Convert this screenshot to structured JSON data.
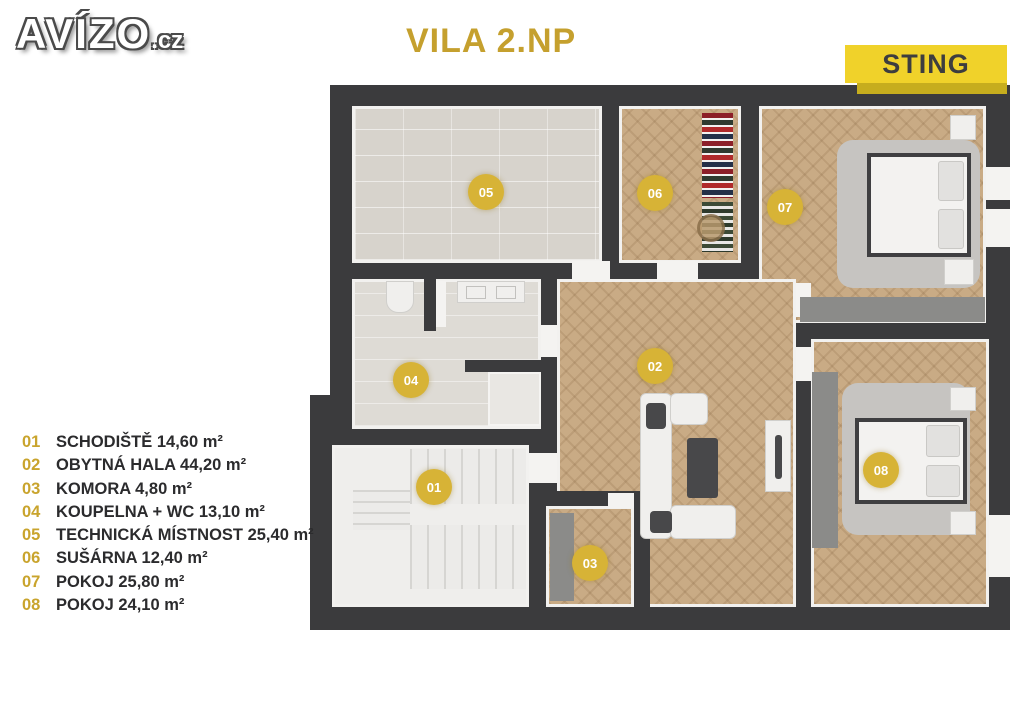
{
  "logo": {
    "main": "AVÍZO",
    "suffix": ".cz"
  },
  "title": "VILA 2.NP",
  "brand_badge": "STING",
  "colors": {
    "accent_gold": "#c5a02e",
    "badge_gold": "#d7b336",
    "sting_yellow": "#f0d22a",
    "wall_dark": "#3b3b3d",
    "wood_floor": "#c9ab85",
    "tile_floor": "#d7d3cc"
  },
  "floorplan": {
    "rooms": [
      {
        "number": "01"
      },
      {
        "number": "02"
      },
      {
        "number": "03"
      },
      {
        "number": "04"
      },
      {
        "number": "05"
      },
      {
        "number": "06"
      },
      {
        "number": "07"
      },
      {
        "number": "08"
      }
    ]
  },
  "legend": {
    "items": [
      {
        "number": "01",
        "label": "SCHODIŠTĚ 14,60 m²"
      },
      {
        "number": "02",
        "label": "OBYTNÁ HALA 44,20 m²"
      },
      {
        "number": "03",
        "label": "KOMORA 4,80 m²"
      },
      {
        "number": "04",
        "label": "KOUPELNA + WC 13,10 m²"
      },
      {
        "number": "05",
        "label": "TECHNICKÁ MÍSTNOST 25,40 m²"
      },
      {
        "number": "06",
        "label": "SUŠÁRNA 12,40 m²"
      },
      {
        "number": "07",
        "label": "POKOJ 25,80 m²"
      },
      {
        "number": "08",
        "label": "POKOJ 24,10 m²"
      }
    ]
  }
}
